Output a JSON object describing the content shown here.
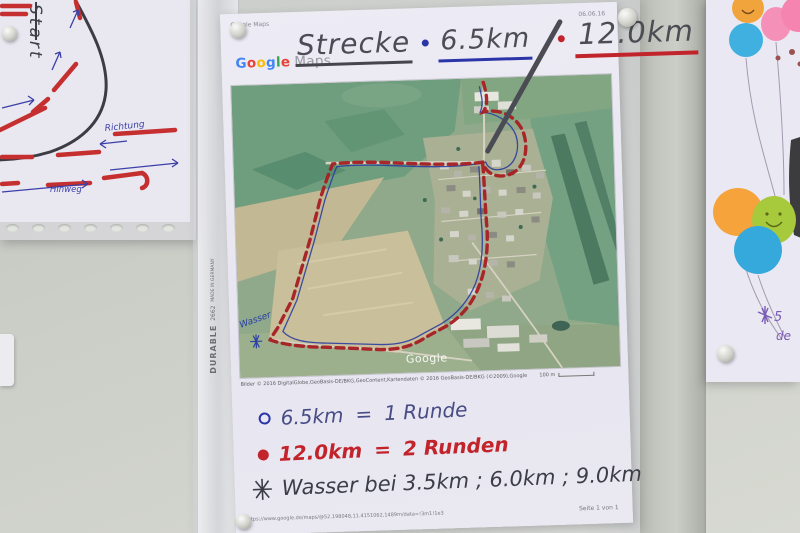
{
  "left_sheet": {
    "start": "Start",
    "richtung": "Richtung",
    "hinweg": "Hinweg"
  },
  "binder": {
    "brand": "DURABLE",
    "model": "2662",
    "made": "MADE IN GERMANY"
  },
  "main_sheet": {
    "header_left": "Google Maps",
    "header_date": "06.06.16",
    "logo_letters": [
      "G",
      "o",
      "o",
      "g",
      "l",
      "e"
    ],
    "logo_maps": "Maps",
    "title_word": "Strecke",
    "bullet": "•",
    "title_dist1": "6.5km",
    "title_slash": "/",
    "title_dist2": "12.0km",
    "map": {
      "watermark": "Google",
      "wasser": "Wasser"
    },
    "credits": "Bilder © 2016 DigitalGlobe,GeoBasis-DE/BKG,GeoContent,Kartendaten © 2016 GeoBasis-DE/BKG (©2009),Google",
    "scale_label": "100 m",
    "legend": [
      {
        "dist": "6.5km",
        "equals": "=",
        "label": "1 Runde"
      },
      {
        "dist": "12.0km",
        "equals": "=",
        "label": "2 Runden"
      }
    ],
    "water_note": {
      "star": "✳",
      "text": "Wasser bei 3.5km ; 6.0km ; 9.0km"
    },
    "footer_url": "https://www.google.de/maps/@52.198048,11.4151062,1489m/data=!3m1!1e3",
    "footer_page": "Seite 1 von 1"
  },
  "right_sheet": {
    "note_top": "5",
    "note_bottom": "de"
  },
  "colors": {
    "route_red": "#a81e22",
    "route_blue": "#2b3d9e",
    "ink_dark": "#45454e",
    "ink_blue": "#2a35a8",
    "ink_red": "#c2242b",
    "balloon_orange": "#f2a43c",
    "balloon_pink": "#f58cb4",
    "balloon_blue": "#3badde",
    "balloon_green": "#a7c93c"
  }
}
